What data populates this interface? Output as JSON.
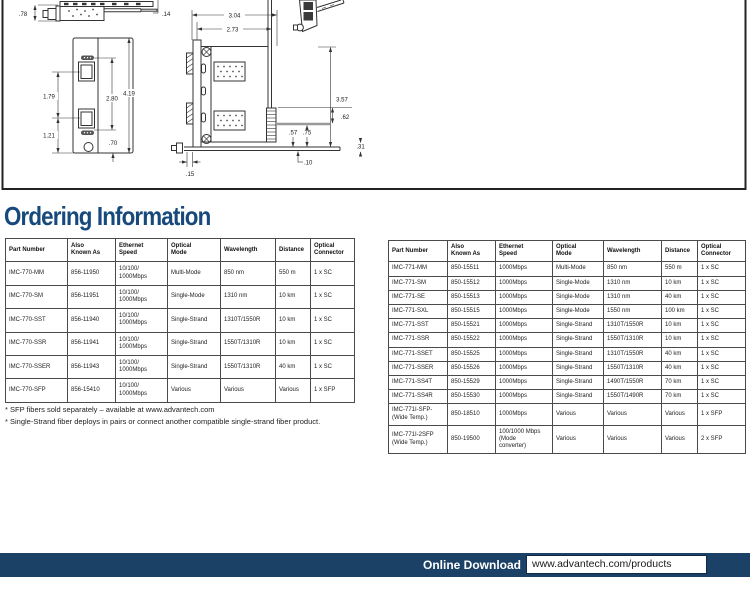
{
  "page": {
    "heading": "Ordering Information",
    "footnotes": [
      "* SFP fibers sold separately – available at www.advantech.com",
      "* Single-Strand fiber deploys in pairs or connect another compatible single-strand fiber product."
    ],
    "footer": {
      "label": "Online Download",
      "url": "www.advantech.com/products"
    },
    "colors": {
      "heading_navy": "#17497C",
      "footer_navy": "#1C4166",
      "table_border": "#4a4a4a",
      "drawing_line": "#333333"
    }
  },
  "drawing": {
    "profile_view": {
      "height": ".78",
      "tab": ".14"
    },
    "front_view": {
      "upper": "1.79",
      "lower": "1.21",
      "ports": "2.80",
      "total": "4.19",
      "bottom": ".70"
    },
    "side_view": {
      "width_total": "3.04",
      "width_body": "2.73",
      "height_total": "3.57",
      "conn": ".62",
      "inner": ".57",
      "edge": ".75",
      "rail": ".31",
      "offset": ".10",
      "plate": ".15"
    }
  },
  "tables": {
    "headers": [
      "Part Number",
      "Also\nKnown As",
      "Ethernet\nSpeed",
      "Optical\nMode",
      "Wavelength",
      "Distance",
      "Optical\nConnector"
    ],
    "left": {
      "rows": [
        [
          "IMC-770-MM",
          "856-11950",
          "10/100/\n1000Mbps",
          "Multi-Mode",
          "850 nm",
          "550 m",
          "1 x SC"
        ],
        [
          "IMC-770-SM",
          "856-11951",
          "10/100/\n1000Mbps",
          "Single-Mode",
          "1310 nm",
          "10 km",
          "1 x SC"
        ],
        [
          "IMC-770-SST",
          "856-11940",
          "10/100/\n1000Mbps",
          "Single-Strand",
          "1310T/1550R",
          "10 km",
          "1 x SC"
        ],
        [
          "IMC-770-SSR",
          "856-11941",
          "10/100/\n1000Mbps",
          "Single-Strand",
          "1550T/1310R",
          "10 km",
          "1 x SC"
        ],
        [
          "IMC-770-SSER",
          "856-11943",
          "10/100/\n1000Mbps",
          "Single-Strand",
          "1550T/1310R",
          "40 km",
          "1 x SC"
        ],
        [
          "IMC-770-SFP",
          "856-15410",
          "10/100/\n1000Mbps",
          "Various",
          "Various",
          "Various",
          "1 x SFP"
        ]
      ]
    },
    "right": {
      "rows": [
        [
          "IMC-771-MM",
          "850-15511",
          "1000Mbps",
          "Multi-Mode",
          "850 nm",
          "550 m",
          "1 x SC"
        ],
        [
          "IMC-771-SM",
          "850-15512",
          "1000Mbps",
          "Single-Mode",
          "1310 nm",
          "10 km",
          "1 x SC"
        ],
        [
          "IMC-771-SE",
          "850-15513",
          "1000Mbps",
          "Single-Mode",
          "1310 nm",
          "40 km",
          "1 x SC"
        ],
        [
          "IMC-771-SXL",
          "850-15515",
          "1000Mbps",
          "Single-Mode",
          "1550 nm",
          "100 km",
          "1 x SC"
        ],
        [
          "IMC-771-SST",
          "850-15521",
          "1000Mbps",
          "Single-Strand",
          "1310T/1550R",
          "10 km",
          "1 x SC"
        ],
        [
          "IMC-771-SSR",
          "850-15522",
          "1000Mbps",
          "Single-Strand",
          "1550T/1310R",
          "10 km",
          "1 x SC"
        ],
        [
          "IMC-771-SSET",
          "850-15525",
          "1000Mbps",
          "Single-Strand",
          "1310T/1550R",
          "40 km",
          "1 x SC"
        ],
        [
          "IMC-771-SSER",
          "850-15526",
          "1000Mbps",
          "Single-Strand",
          "1550T/1310R",
          "40 km",
          "1 x SC"
        ],
        [
          "IMC-771-SS4T",
          "850-15529",
          "1000Mbps",
          "Single-Strand",
          "1490T/1550R",
          "70 km",
          "1 x SC"
        ],
        [
          "IMC-771-SS4R",
          "850-15530",
          "1000Mbps",
          "Single-Strand",
          "1550T/1490R",
          "70 km",
          "1 x SC"
        ],
        [
          "IMC-771I-SFP-\n(Wide Temp.)",
          "850-18510",
          "1000Mbps",
          "Various",
          "Various",
          "Various",
          "1 x SFP"
        ],
        [
          "IMC-771I-2SFP\n(Wide Temp.)",
          "850-19500",
          "100/1000 Mbps\n(Mode\nconverter)",
          "Various",
          "Various",
          "Various",
          "2 x SFP"
        ]
      ]
    }
  }
}
